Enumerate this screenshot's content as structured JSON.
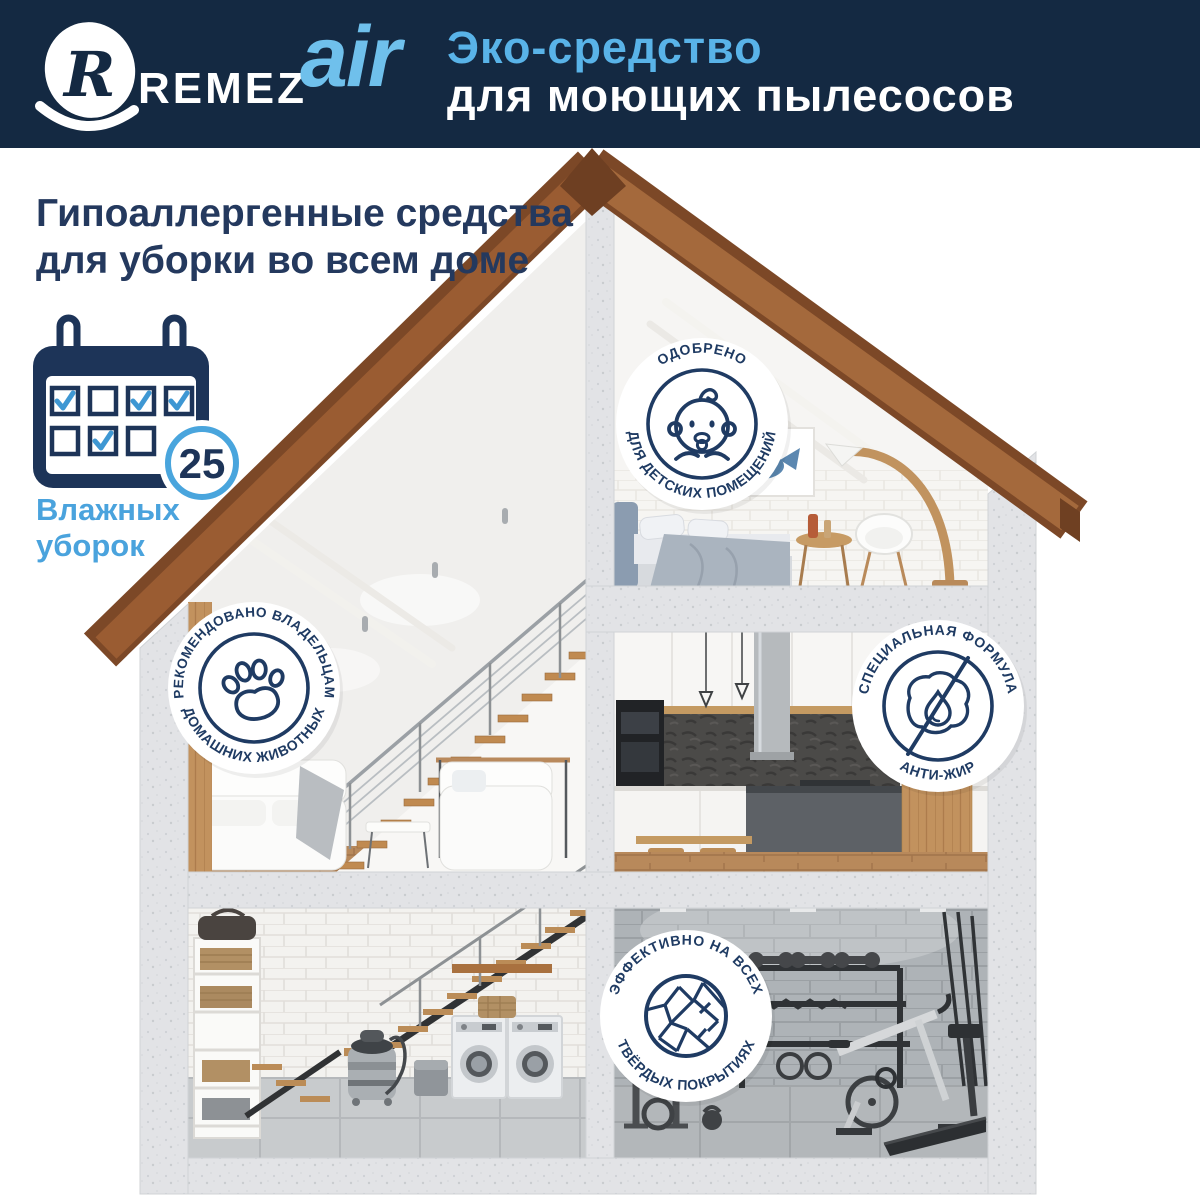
{
  "header": {
    "brand_remez": "REMEZ",
    "brand_air": "air",
    "title_line1": "Эко-средство",
    "title_line2": "для моющих пылесосов"
  },
  "heading": {
    "line1": "Гипоаллергенные средства",
    "line2": "для уборки во всем доме"
  },
  "wet_cleaning_counter": {
    "value": "25",
    "label_line1": "Влажных",
    "label_line2": "уборок"
  },
  "calendar": {
    "row1_checks": [
      true,
      false,
      true,
      true
    ],
    "row2_checks": [
      false,
      true,
      false
    ]
  },
  "badges": [
    {
      "name": "kids-rooms-approved",
      "icon": "baby-icon",
      "arc_top": "ОДОБРЕНО",
      "arc_bottom": "ДЛЯ ДЕТСКИХ ПОМЕЩЕНИЙ"
    },
    {
      "name": "pet-owners-recommended",
      "icon": "paw-icon",
      "arc_top": "РЕКОМЕНДОВАНО ВЛАДЕЛЬЦАМ",
      "arc_bottom": "ДОМАШНИХ ЖИВОТНЫХ"
    },
    {
      "name": "anti-grease-formula",
      "icon": "no-grease-icon",
      "arc_top": "СПЕЦИАЛЬНАЯ ФОРМУЛА",
      "arc_bottom": "АНТИ-ЖИР"
    },
    {
      "name": "hard-surfaces-effective",
      "icon": "tiles-icon",
      "arc_top": "ЭФФЕКТИВНО НА ВСЕХ",
      "arc_bottom": "ТВЁРДЫХ ПОКРЫТИЯХ"
    }
  ],
  "colors": {
    "header_navy": "#142942",
    "badge_navy": "#1f3b63",
    "accent_blue": "#59b3e8",
    "light_blue": "#4aa3dd",
    "roof_brown": "#9a5c32",
    "wood": "#c2925e",
    "concrete": "#e2e3e6"
  }
}
